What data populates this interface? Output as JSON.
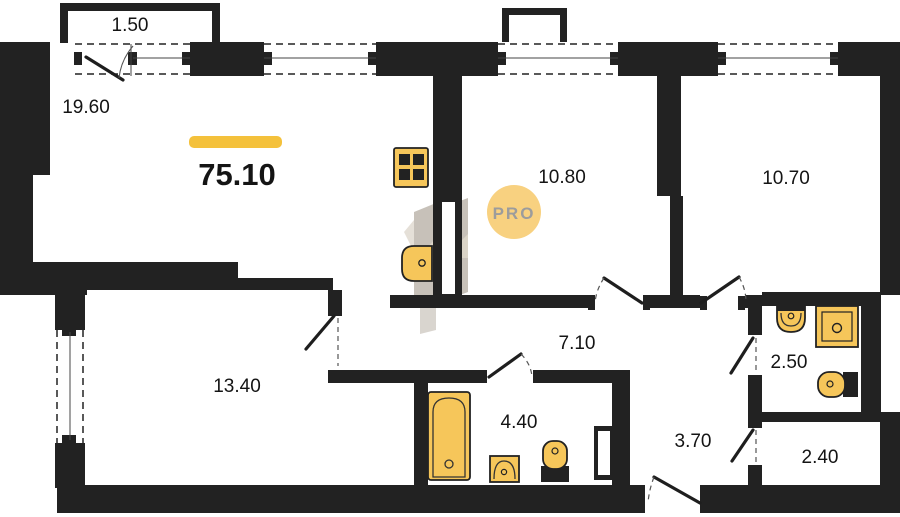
{
  "plan": {
    "total_area": "75.10",
    "balcony_area": "1.50",
    "watermark_text": "PRO",
    "room_areas": [
      "19.60",
      "10.80",
      "10.70",
      "13.40",
      "7.10",
      "4.40",
      "3.70",
      "2.50",
      "2.40"
    ],
    "colors": {
      "wall": "#222222",
      "fixture_fill": "#F6C65A",
      "accent_bar": "#F4C13B",
      "watermark_circle": "#F8D180",
      "watermark_text": "#9C9C9C",
      "label_text": "#141414",
      "background": "#FFFFFF"
    }
  }
}
